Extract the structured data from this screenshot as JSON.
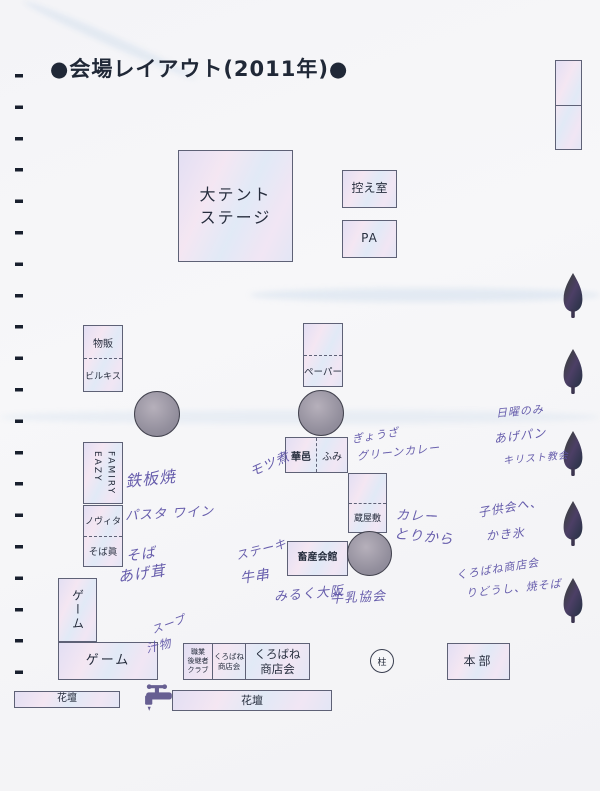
{
  "title": "●会場レイアウト(2011年)●",
  "areas": {
    "stage": "大テント\nステージ",
    "waiting_room": "控え室",
    "pa": "PA",
    "buppan": "物販",
    "birukisu": "ビルキス",
    "eazy_family": "EAZY\nFAMIRY",
    "novita": "ノヴィタ",
    "soba_shin": "そば眞",
    "paper": "ペーパー",
    "kamura": "華邑",
    "fumi": "ふみ",
    "kurayashiki": "蔵屋敷",
    "chikusan_kaikan": "畜産会館",
    "game_vertical": "ゲーム",
    "game_horizontal": "ゲーム",
    "shokugyo_club": "職業\n後継者\nクラブ",
    "kurobane_small": "くろばね\n商店会",
    "kurobane_large": "くろばね\n商店会",
    "hashira": "柱",
    "honbu": "本部",
    "kadan_left": "花壇",
    "kadan_right": "花壇"
  },
  "annotations": {
    "teppanyaki": "鉄板焼",
    "pasta": "パスタ ワイン",
    "soba": "そば",
    "agedake": "あげ茸",
    "motsuni": "モツ煮",
    "gyoza": "ぎょうざ",
    "green_curry": "グリーンカレー",
    "curry": "カレー",
    "torikara": "とりから",
    "steak": "ステーキ",
    "gyukushi": "牛串",
    "milk_osaka": "みるく大阪",
    "gyunyu_kyokai": "牛乳協会",
    "sunday_only": "日曜のみ",
    "agepan": "あげパン",
    "christ_church": "キリスト教会",
    "kodomokai": "子供会へ、",
    "kakigori": "かき氷",
    "kurobane_note": "くろばね商店会",
    "yakisoba_note": "りどうし、焼そば",
    "soup": "スープ",
    "shirumono": "汁物"
  },
  "icons": {
    "tree": "tree-icon",
    "faucet": "faucet-icon"
  },
  "colors": {
    "ink": "#5b51a6",
    "box_border": "#5e6176",
    "paper": "#f5f5f7"
  }
}
